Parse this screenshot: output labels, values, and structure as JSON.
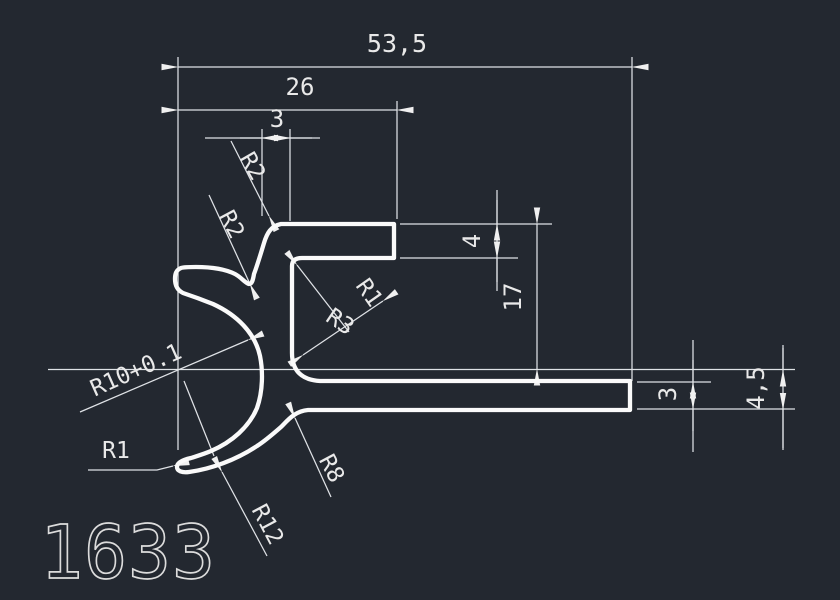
{
  "app": {
    "type": "cad-drawing",
    "colors": {
      "background": "#232830",
      "profile_line": "#FAFAFA",
      "dimension_line": "#DFE2E6",
      "text": "#E9E9E9"
    }
  },
  "drawing": {
    "part_number": "1633",
    "dimensions": {
      "overall_width": "53,5",
      "upper_width": "26",
      "wall_thickness_top": "3",
      "flange_thickness": "4",
      "cavity_height": "17",
      "arm_tip_thickness": "3",
      "arm_root_thickness": "4,5"
    },
    "radii": {
      "r2_outer": "R2",
      "r2_valley": "R2",
      "r1_inner_corner": "R1",
      "r3_fillet": "R3",
      "r10_bore": "R10+0.1",
      "r1_hook_tip": "R1",
      "r8_fillet": "R8",
      "r12_hook": "R12"
    }
  }
}
